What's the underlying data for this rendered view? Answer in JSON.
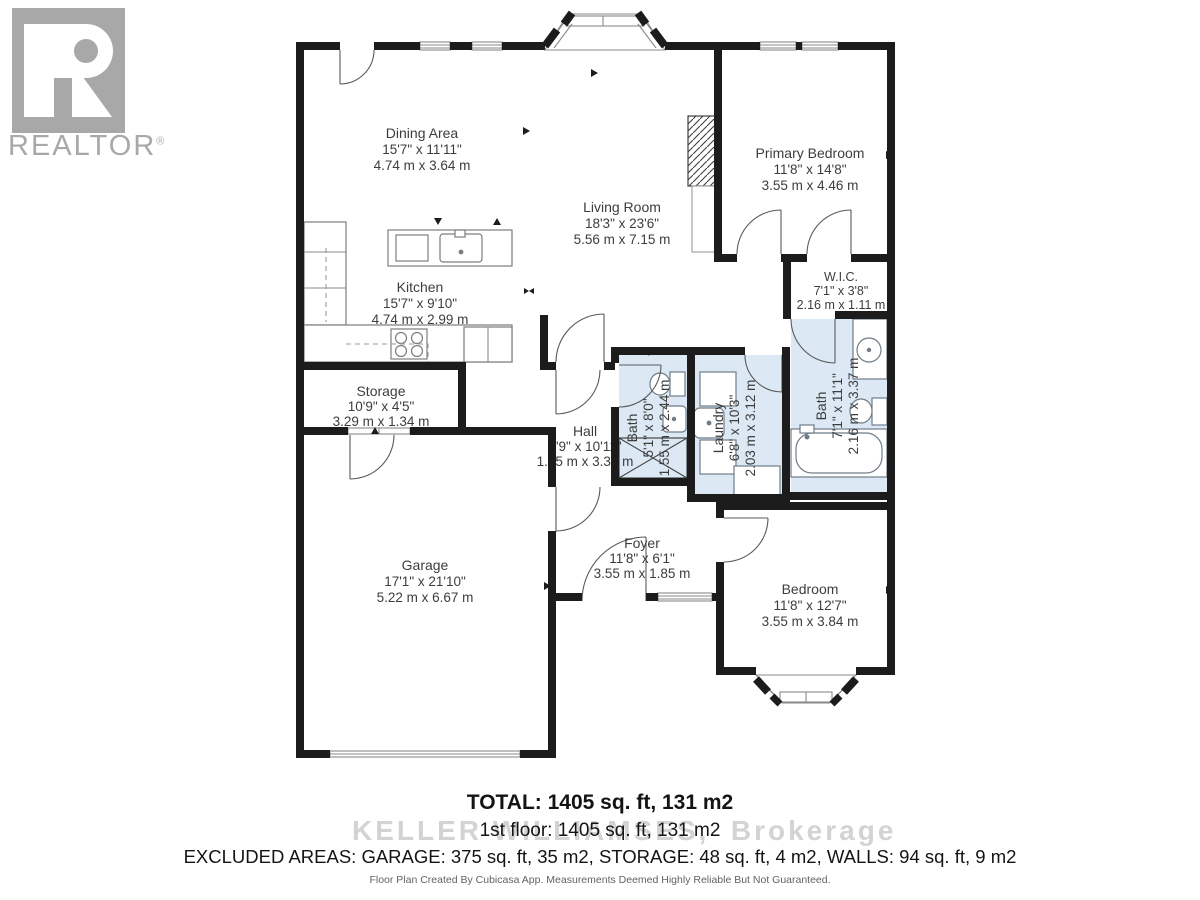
{
  "logo": {
    "brand": "REALTOR",
    "registered": "®"
  },
  "rooms": {
    "dining": {
      "name": "Dining Area",
      "imperial": "15'7\" x 11'11\"",
      "metric": "4.74 m x 3.64 m"
    },
    "living": {
      "name": "Living Room",
      "imperial": "18'3\" x 23'6\"",
      "metric": "5.56 m x 7.15 m"
    },
    "primary_bedroom": {
      "name": "Primary Bedroom",
      "imperial": "11'8\" x 14'8\"",
      "metric": "3.55 m x 4.46 m"
    },
    "kitchen": {
      "name": "Kitchen",
      "imperial": "15'7\" x 9'10\"",
      "metric": "4.74 m x 2.99 m"
    },
    "wic": {
      "name": "W.I.C.",
      "imperial": "7'1\" x 3'8\"",
      "metric": "2.16 m x 1.11 m"
    },
    "storage": {
      "name": "Storage",
      "imperial": "10'9\" x 4'5\"",
      "metric": "3.29 m x 1.34 m"
    },
    "hall": {
      "name": "Hall",
      "imperial": "4'9\" x 10'11\"",
      "metric": "1.45 m x 3.32 m"
    },
    "bath_small": {
      "name": "Bath",
      "imperial": "5'1\" x 8'0\"",
      "metric": "1.55 m x 2.44 m"
    },
    "laundry": {
      "name": "Laundry",
      "imperial": "6'8\" x 10'3\"",
      "metric": "2.03 m x 3.12 m"
    },
    "bath_main": {
      "name": "Bath",
      "imperial": "7'1\" x 11'1\"",
      "metric": "2.16 m x 3.37 m"
    },
    "garage": {
      "name": "Garage",
      "imperial": "17'1\" x 21'10\"",
      "metric": "5.22 m x 6.67 m"
    },
    "foyer": {
      "name": "Foyer",
      "imperial": "11'8\" x 6'1\"",
      "metric": "3.55 m x 1.85 m"
    },
    "bedroom": {
      "name": "Bedroom",
      "imperial": "11'8\" x 12'7\"",
      "metric": "3.55 m x 3.84 m"
    }
  },
  "summary": {
    "total": "TOTAL: 1405 sq. ft, 131 m2",
    "first_floor": "1st floor: 1405 sq. ft, 131 m2",
    "excluded": "EXCLUDED AREAS: GARAGE: 375 sq. ft, 35 m2, STORAGE: 48 sq. ft, 4 m2, WALLS: 94 sq. ft, 9 m2",
    "disclaimer": "Floor Plan Created By Cubicasa App. Measurements Deemed Highly Reliable But Not Guaranteed."
  },
  "watermark": {
    "left": "KELLER WILLIAMS",
    "right": "ES,  Brokerage"
  },
  "colors": {
    "wall": "#1c1c1c",
    "wet_room": "#dce9f4",
    "label": "#3d3d3d",
    "watermark": "#cccccc",
    "logo": "#a8a8a8"
  }
}
